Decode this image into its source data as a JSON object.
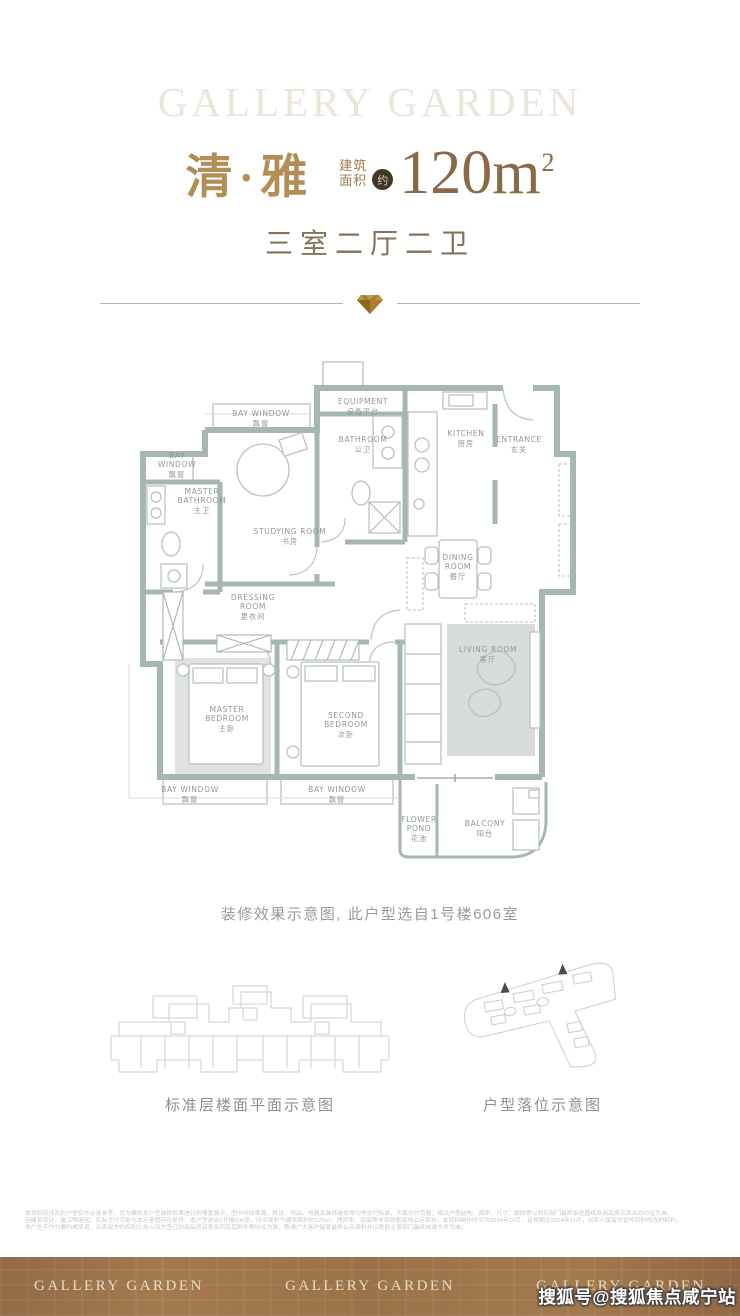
{
  "brand": {
    "top_watermark": "GALLERY GARDEN"
  },
  "header": {
    "unit_name": "清·雅",
    "area_label_line1": "建筑",
    "area_label_line2": "面积",
    "area_approx_badge": "约",
    "area_value": "120m",
    "area_sup": "2",
    "layout_summary": "三室二厅二卫"
  },
  "floorplan": {
    "caption": "装修效果示意图, 此户型选自1号楼606室",
    "rooms": [
      {
        "id": "bay-window-top",
        "l1": "BAY WINDOW",
        "zh": "飘窗"
      },
      {
        "id": "equipment",
        "l1": "EQUIPMENT",
        "zh": "设备平台"
      },
      {
        "id": "bathroom",
        "l1": "BATHROOM",
        "zh": "公卫"
      },
      {
        "id": "kitchen",
        "l1": "KITCHEN",
        "zh": "厨房"
      },
      {
        "id": "entrance",
        "l1": "ENTRANCE",
        "zh": "玄关"
      },
      {
        "id": "bay-window-left",
        "l1": "BAY",
        "l2": "WINDOW",
        "zh": "飘窗"
      },
      {
        "id": "master-bathroom",
        "l1": "MASTER",
        "l2": "BATHROOM",
        "zh": "主卫"
      },
      {
        "id": "studying-room",
        "l1": "STUDYING ROOM",
        "zh": "书房"
      },
      {
        "id": "dining-room",
        "l1": "DINING",
        "l2": "ROOM",
        "zh": "餐厅"
      },
      {
        "id": "dressing-room",
        "l1": "DRESSING",
        "l2": "ROOM",
        "zh": "更衣间"
      },
      {
        "id": "master-bedroom",
        "l1": "MASTER",
        "l2": "BEDROOM",
        "zh": "主卧"
      },
      {
        "id": "second-bedroom",
        "l1": "SECOND",
        "l2": "BEDROOM",
        "zh": "次卧"
      },
      {
        "id": "living-room",
        "l1": "LIVING ROOM",
        "zh": "客厅"
      },
      {
        "id": "bay-window-bottom-left",
        "l1": "BAY WINDOW",
        "zh": "飘窗"
      },
      {
        "id": "bay-window-bottom-mid",
        "l1": "BAY WINDOW",
        "zh": "飘窗"
      },
      {
        "id": "flower-pond",
        "l1": "FLOWER",
        "l2": "POND",
        "zh": "花池"
      },
      {
        "id": "balcony",
        "l1": "BALCONY",
        "zh": "阳台"
      }
    ]
  },
  "diagrams": {
    "left_caption": "标准层楼面平面示意图",
    "right_caption": "户型落位示意图"
  },
  "disclaimer": {
    "line1": "本资料所涉及的户型仅作示意参考，仅为模拟本户型装修效果进行的情景展示，图中所绘家具、陈设、饰品、电器及装饰装修等均非交付标准，不属交付范围；相关户型结构、面积、尺寸、朝向等以政府部门最终审批图纸及商品房买卖合同约定为准。",
    "line2": "因建筑设计、施工等原因，实际交付可能与本示意图存在差异；本户型选自1号楼606室，所示面积为建筑面积约120㎡，得房率、层高等详见销售现场公示资料。本资料制作时间为2024年10月，有效期至2024年11月，出卖人保留对宣传资料修改的权利。",
    "line3": "本广告不作为要约或承诺，买卖双方的权利义务以双方签订的商品房买卖合同及其附件等协议为准，敬请广大客户留意最新公示资料并以政府主管部门最终核准文件为准。"
  },
  "footer": {
    "brands": [
      "GALLERY GARDEN",
      "GALLERY GARDEN",
      "GALLERY GARDEN"
    ],
    "watermark": "搜狐号@搜狐焦点咸宁站"
  },
  "colors": {
    "title_gold": "#b28e56",
    "area_brown": "#8a6946",
    "subtitle_brown": "#857258",
    "wall_green_gray": "#a6b7b2",
    "label_gray": "#8f9994",
    "footer_brown": "#9c7249",
    "footer_text_cream": "#e9dcc2",
    "gem_gold": "#a87e33"
  }
}
